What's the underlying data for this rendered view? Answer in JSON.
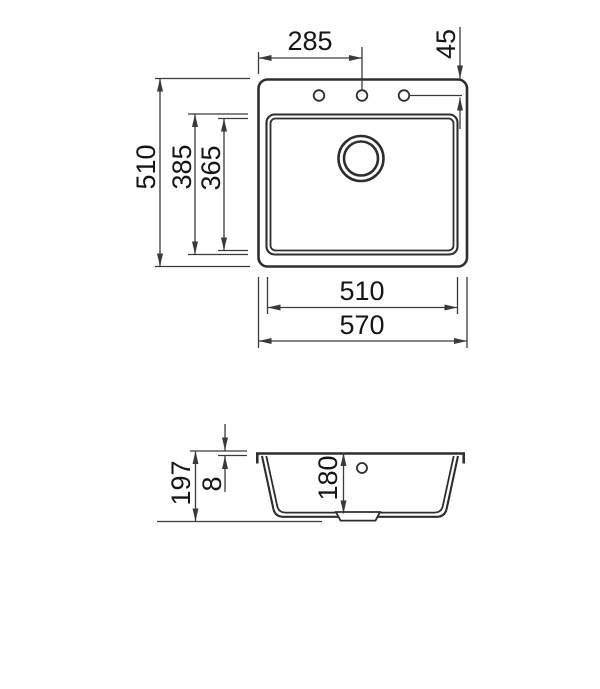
{
  "drawing": {
    "kind": "technical-dimension-drawing",
    "subject": "single-bowl kitchen sink, top view and side section view",
    "units": "mm",
    "colors": {
      "background": "#ffffff",
      "outline": "#2e2e2e",
      "dimension_line": "#3a3a3a",
      "text": "#151515"
    },
    "top_view": {
      "faucet_hole_count": 3,
      "dims": {
        "faucet_center_offset": "285",
        "hole_setback": "45",
        "overall_depth": "510",
        "bowl_outer_depth": "385",
        "bowl_inner_depth": "365",
        "bowl_width": "510",
        "overall_width": "570"
      }
    },
    "side_view": {
      "dims": {
        "overall_height": "197",
        "rim_thickness": "8",
        "bowl_depth": "180"
      }
    }
  }
}
